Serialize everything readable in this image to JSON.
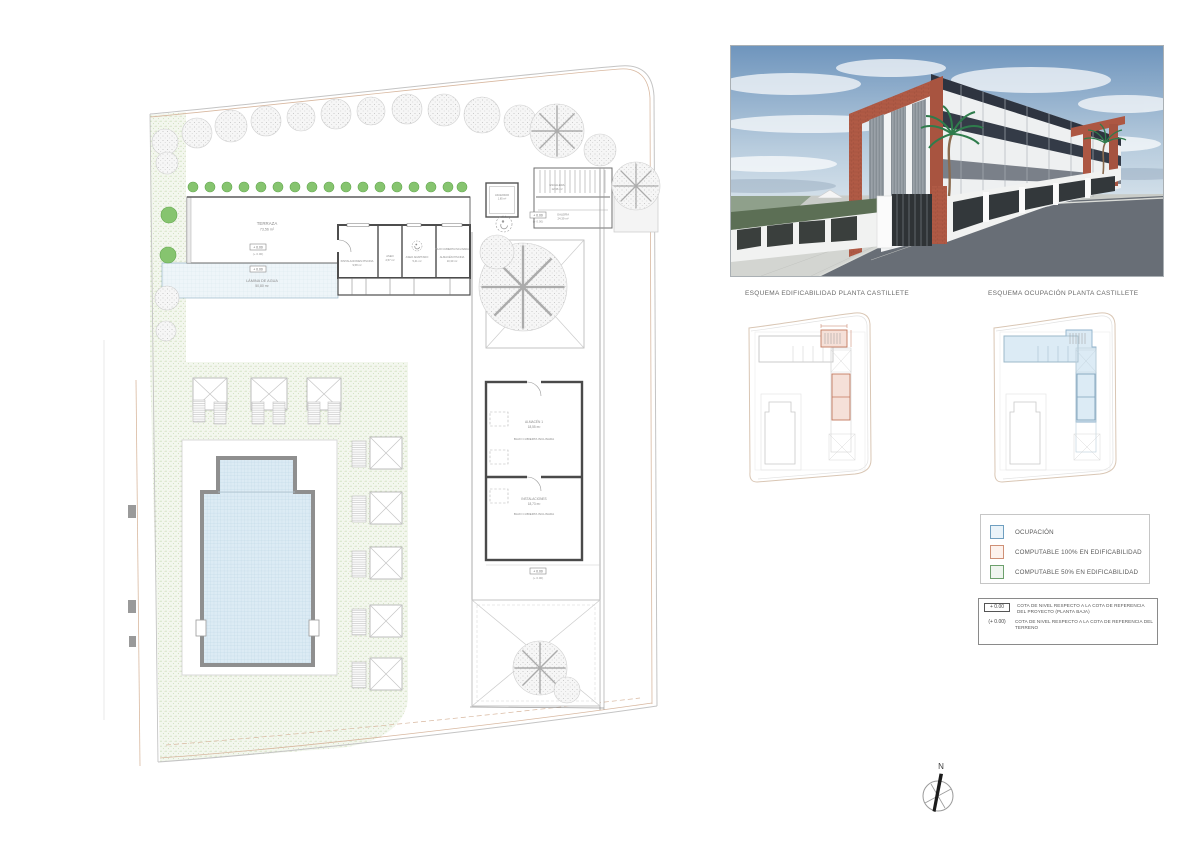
{
  "colors": {
    "legend_blue_border": "#6f9fc0",
    "legend_blue_fill": "#eaf3f9",
    "legend_orange_border": "#cf9076",
    "legend_orange_fill": "#fdf2ed",
    "legend_green_border": "#6da06d",
    "legend_green_fill": "#eff5ef",
    "render_terracotta": "#b05a45",
    "plan_green": "#7cbf6b",
    "pool_blue": "#dcebf4"
  },
  "site_plan": {
    "labels": {
      "terraza": "TERRAZA",
      "terraza_area": "73,56 m²",
      "lamina_de_agua": "LÁMINA DE AGUA",
      "lamina_de_agua_area": "50,80 m²",
      "instalaciones_piscina": "INSTALACIONES PISCINA",
      "instalaciones_piscina_area": "9,58 m²",
      "aseo": "ASEO",
      "aseo_area": "2,57 m²",
      "aseo_adaptado": "ASEO ADAPTADO",
      "aseo_adaptado_area": "5,41 m²",
      "almacen_piscina": "ALMACÉN PISCINA",
      "almacen_piscina_area": "10,30 m²",
      "bajo_cubierta": "BAJO CUBIERTA INCLINADA",
      "ascensor": "ASCENSOR",
      "ascensor_area": "1,85 m²",
      "escalera": "ESCALERA",
      "escalera_area": "12,36 m²",
      "galeria": "GALERÍA",
      "galeria_area": "24,39 m²",
      "almacen_1": "ALMACÉN 1",
      "almacen_1_area": "18,55 m²",
      "instalaciones": "INSTALACIONES",
      "instalaciones_area": "18,73 m²"
    },
    "level_marker_boxed": "+ 0.00",
    "level_marker_paren": "(+ 0.00)"
  },
  "schematics": {
    "left_title": "ESQUEMA EDIFICABILIDAD PLANTA CASTILLETE",
    "right_title": "ESQUEMA OCUPACIÓN PLANTA CASTILLETE"
  },
  "legend": {
    "items": [
      {
        "label": "OCUPACIÓN",
        "fill": "#eaf3f9",
        "border": "#6f9fc0"
      },
      {
        "label": "COMPUTABLE 100% EN EDIFICABILIDAD",
        "fill": "#fdf2ed",
        "border": "#cf9076"
      },
      {
        "label": "COMPUTABLE 50% EN EDIFICABILIDAD",
        "fill": "#eff5ef",
        "border": "#6da06d"
      }
    ]
  },
  "notes": {
    "rows": [
      {
        "symbol": "+ 0.00",
        "text": "COTA DE NIVEL RESPECTO A LA COTA DE REFERENCIA DEL PROYECTO (PLANTA BAJA)"
      },
      {
        "symbol": "(+ 0.00)",
        "text": "COTA DE NIVEL RESPECTO A LA COTA DE REFERENCIA DEL TERRENO"
      }
    ]
  },
  "compass": {
    "label": "N"
  }
}
